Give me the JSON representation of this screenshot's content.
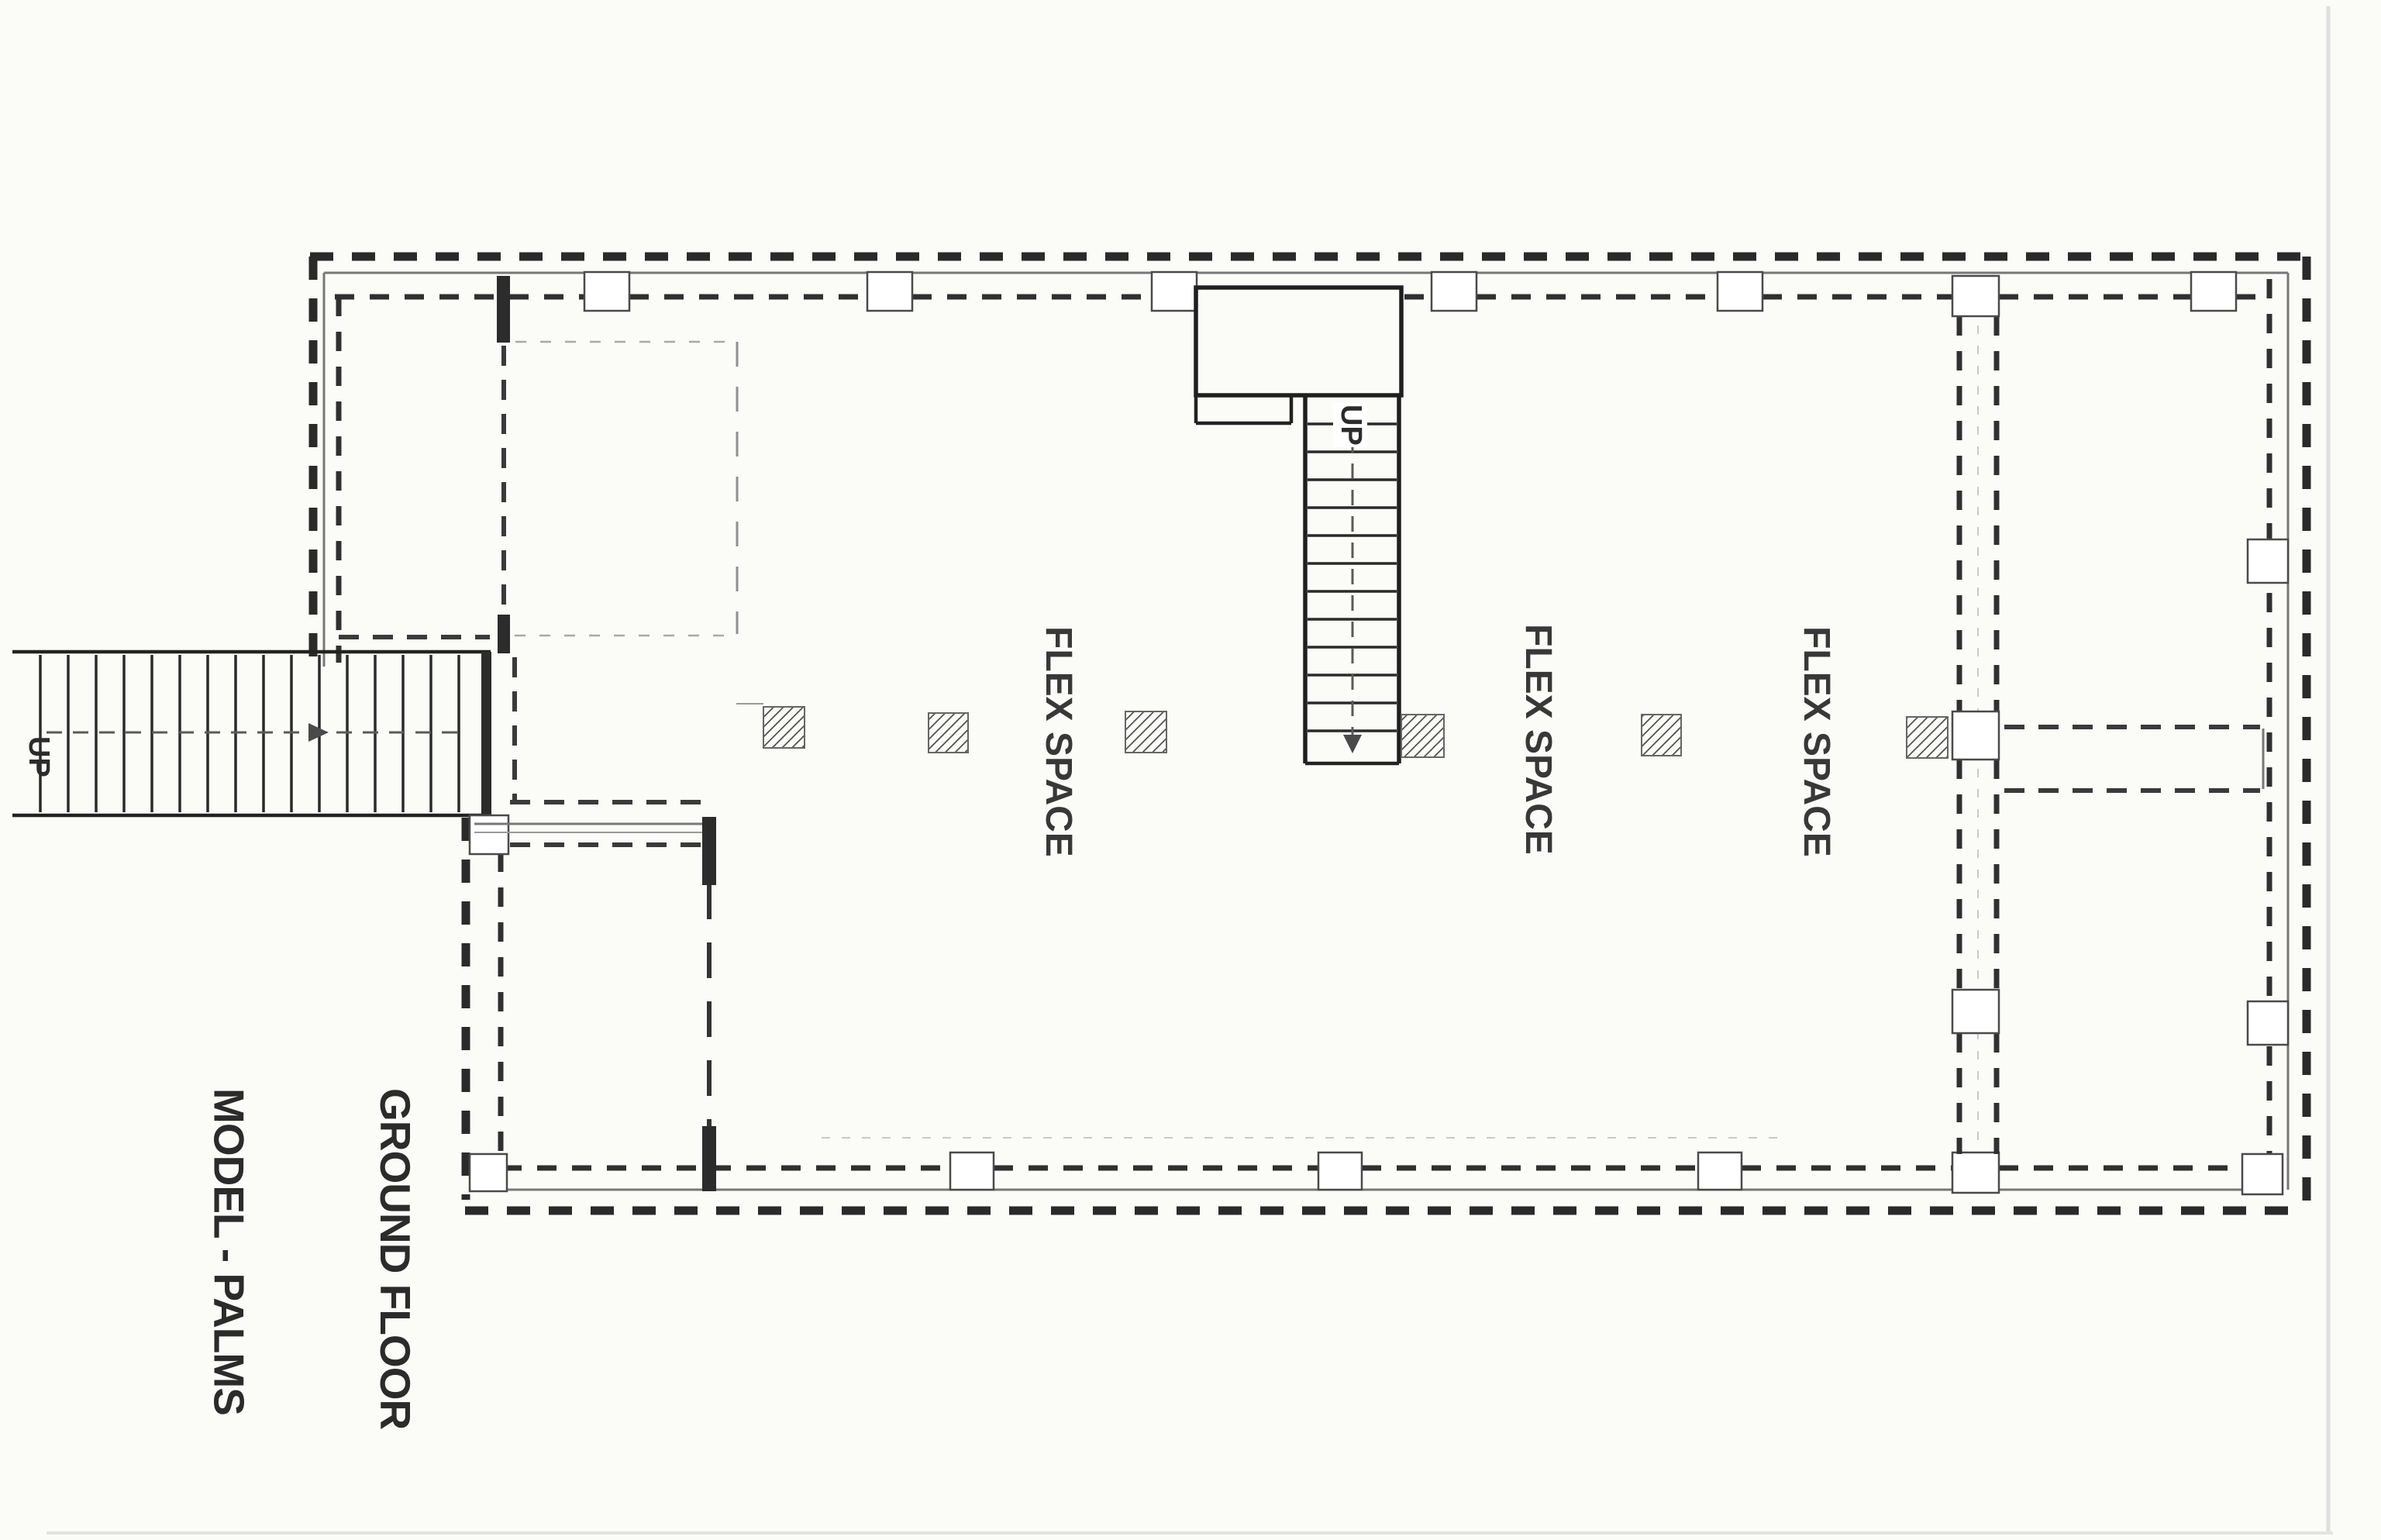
{
  "page": {
    "paper_color": "#fbfbf8",
    "ink_color": "#2b2b2b",
    "faint_ink_color": "#9e9e9e"
  },
  "title": {
    "line1": "MODEL - PALMS",
    "line2": "GROUND FLOOR"
  },
  "labels": {
    "flex_spaces": [
      "FLEX SPACE",
      "FLEX SPACE",
      "FLEX SPACE"
    ],
    "exterior_stair_up": "UP",
    "interior_stair_up": "UP"
  }
}
